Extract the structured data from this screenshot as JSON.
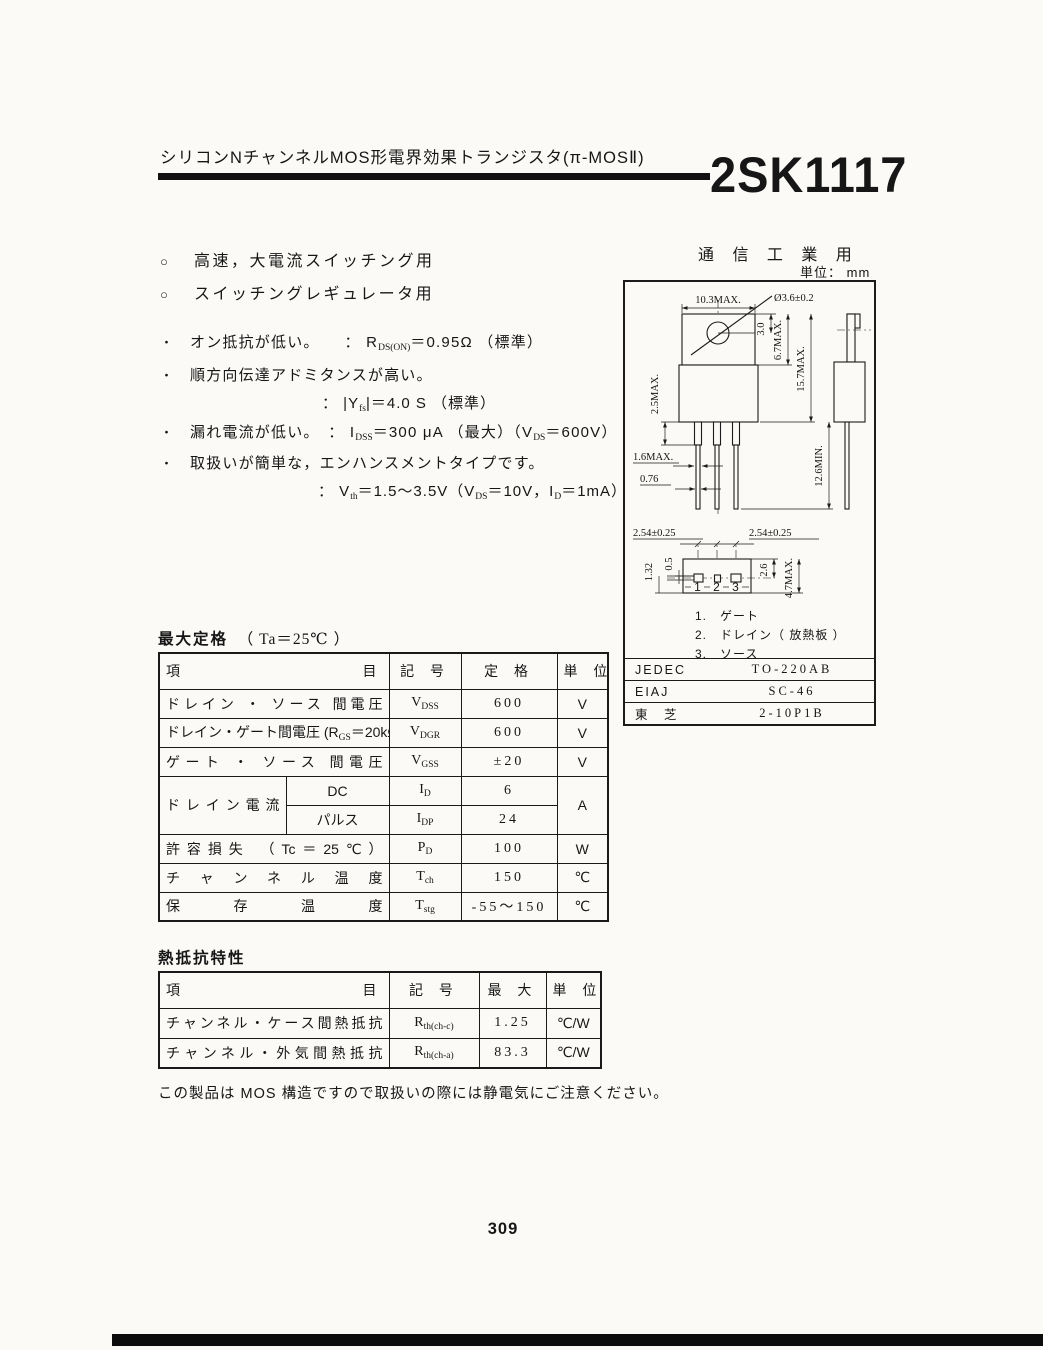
{
  "header": {
    "title": "シリコンNチャンネルMOS形電界効果トランジスタ(π-MOSⅡ)",
    "part_number": "2SK1117"
  },
  "applications": {
    "marker": "○",
    "items": [
      "高速，大電流スイッチング用",
      "スイッチングレギュレータ用"
    ]
  },
  "features": {
    "marker": "・",
    "lines": [
      "オン抵抗が低い。　　： R~DS(ON)~＝0.95Ω （標準）",
      "順方向伝達アドミタンスが高い。",
      "： |Y~fs~|＝4.0 S （標準）",
      "漏れ電流が低い。　： I~DSS~＝300 μA （最大）（V~DS~＝600V）",
      "取扱いが簡単な，エンハンスメントタイプです。",
      "： V~th~＝1.5～3.5V（V~DS~＝10V，I~D~＝1mA）"
    ]
  },
  "drawing": {
    "heading": "通 信 工 業 用",
    "unit_label": "単位： mm",
    "dims": {
      "top_width": "10.3MAX.",
      "hole_dia": "Ø3.6±0.2",
      "hole_offset": "3.0",
      "tab_height": "6.7MAX.",
      "body_height": "15.7MAX.",
      "shoulder": "2.5MAX.",
      "lead_w1": "1.6MAX.",
      "lead_w2": "0.76",
      "lead_len": "12.6MIN.",
      "pitch_left": "2.54±0.25",
      "pitch_right": "2.54±0.25",
      "bv_offset1": "0.5",
      "bv_offset2": "1.32",
      "bv_depth1": "2.6",
      "bv_depth2": "4.7MAX."
    },
    "pins": [
      "1",
      "2",
      "3"
    ],
    "pin_legend": [
      "1.　ゲート",
      "2.　ドレイン（ 放熱板 ）",
      "3.　ソース"
    ],
    "package_table": [
      {
        "label": "JEDEC",
        "value": "TO-220AB"
      },
      {
        "label": "EIAJ",
        "value": "SC-46"
      },
      {
        "label": "東　芝",
        "value": "2-10P1B"
      }
    ]
  },
  "max_ratings": {
    "title": "最大定格",
    "condition": "（ Ta＝25℃ ）",
    "headers": [
      "項 目",
      "記 号",
      "定 格",
      "単 位"
    ],
    "rows": [
      {
        "item": "ドレイン ・ ソース 間電圧",
        "symbol": "V~DSS~",
        "rating": "600",
        "unit": "V"
      },
      {
        "item": "ドレイン・ゲート間電圧 (R~GS~＝20kΩ)",
        "symbol": "V~DGR~",
        "rating": "600",
        "unit": "V"
      },
      {
        "item": "ゲート ・ ソース 間電圧",
        "symbol": "V~GSS~",
        "rating": "±20",
        "unit": "V"
      },
      {
        "item": "ドレイン電流",
        "sub": "DC",
        "symbol": "I~D~",
        "rating": "6",
        "unit": "A"
      },
      {
        "sub": "パルス",
        "symbol": "I~DP~",
        "rating": "24"
      },
      {
        "item": "許容損失 （Tc＝25℃）",
        "symbol": "P~D~",
        "rating": "100",
        "unit": "W"
      },
      {
        "item": "チャンネル温度",
        "symbol": "T~ch~",
        "rating": "150",
        "unit": "℃"
      },
      {
        "item": "保存温度",
        "symbol": "T~stg~",
        "rating": "-55～150",
        "unit": "℃"
      }
    ]
  },
  "thermal": {
    "title": "熱抵抗特性",
    "headers": [
      "項 目",
      "記 号",
      "最 大",
      "単 位"
    ],
    "rows": [
      {
        "item": "チャンネル・ケース間熱抵抗",
        "symbol": "R~th(ch-c)~",
        "max": "1.25",
        "unit": "℃/W"
      },
      {
        "item": "チャンネル・外気間熱抵抗",
        "symbol": "R~th(ch-a)~",
        "max": "83.3",
        "unit": "℃/W"
      }
    ]
  },
  "note": "この製品は MOS 構造ですので取扱いの際には静電気にご注意ください。",
  "page_number": "309"
}
